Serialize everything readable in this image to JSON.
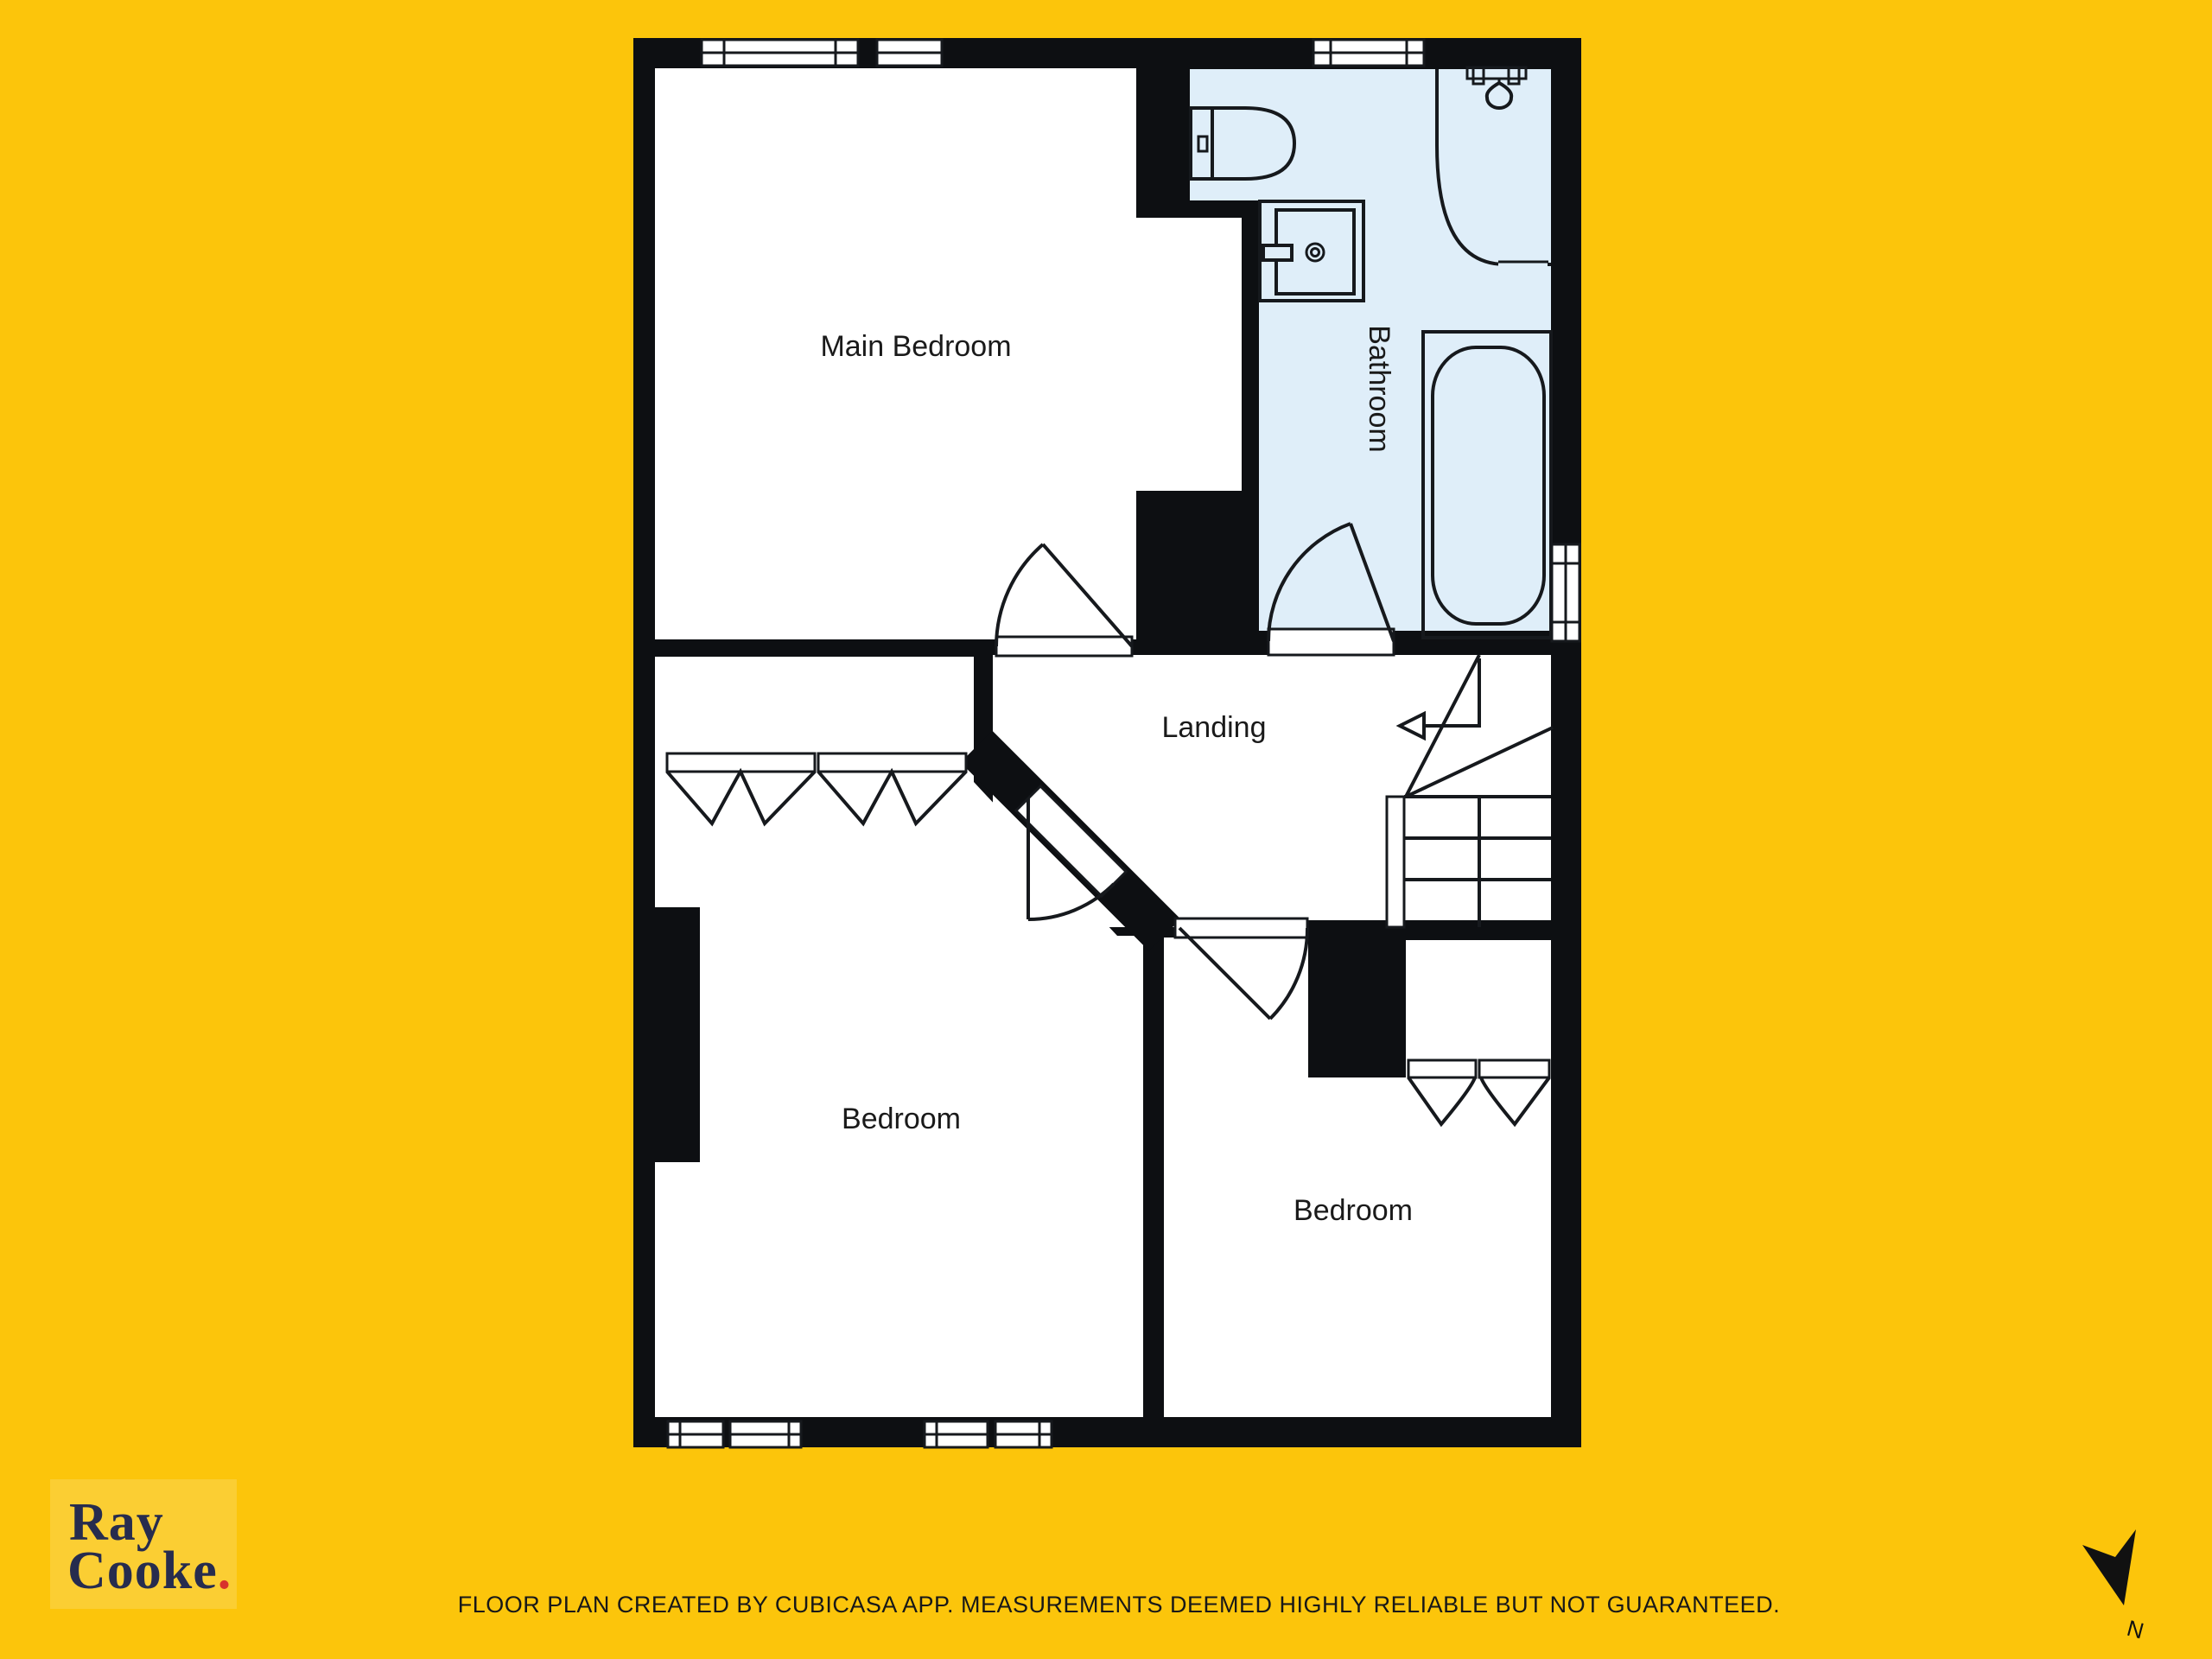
{
  "colors": {
    "background": "#fcc50b",
    "bathroom_fill": "#dfeef9",
    "wall": "#0d0f12",
    "line": "#16191d",
    "room_fill": "#ffffff",
    "label_color": "#1a1a1a",
    "logo_navy": "#272c4e",
    "logo_dot_red": "#d8332c",
    "logo_panel": "#fbce33"
  },
  "rooms": [
    {
      "label": "Main Bedroom"
    },
    {
      "label": "Bathroom"
    },
    {
      "label": "Landing"
    },
    {
      "label": "Bedroom"
    },
    {
      "label": "Bedroom"
    }
  ],
  "branding": {
    "line1": "Ray",
    "line2": "Cooke",
    "dot": "."
  },
  "footer": {
    "disclaimer": "FLOOR PLAN CREATED BY CUBICASA APP. MEASUREMENTS DEEMED HIGHLY RELIABLE BUT NOT GUARANTEED."
  },
  "compass": {
    "label": "N"
  }
}
